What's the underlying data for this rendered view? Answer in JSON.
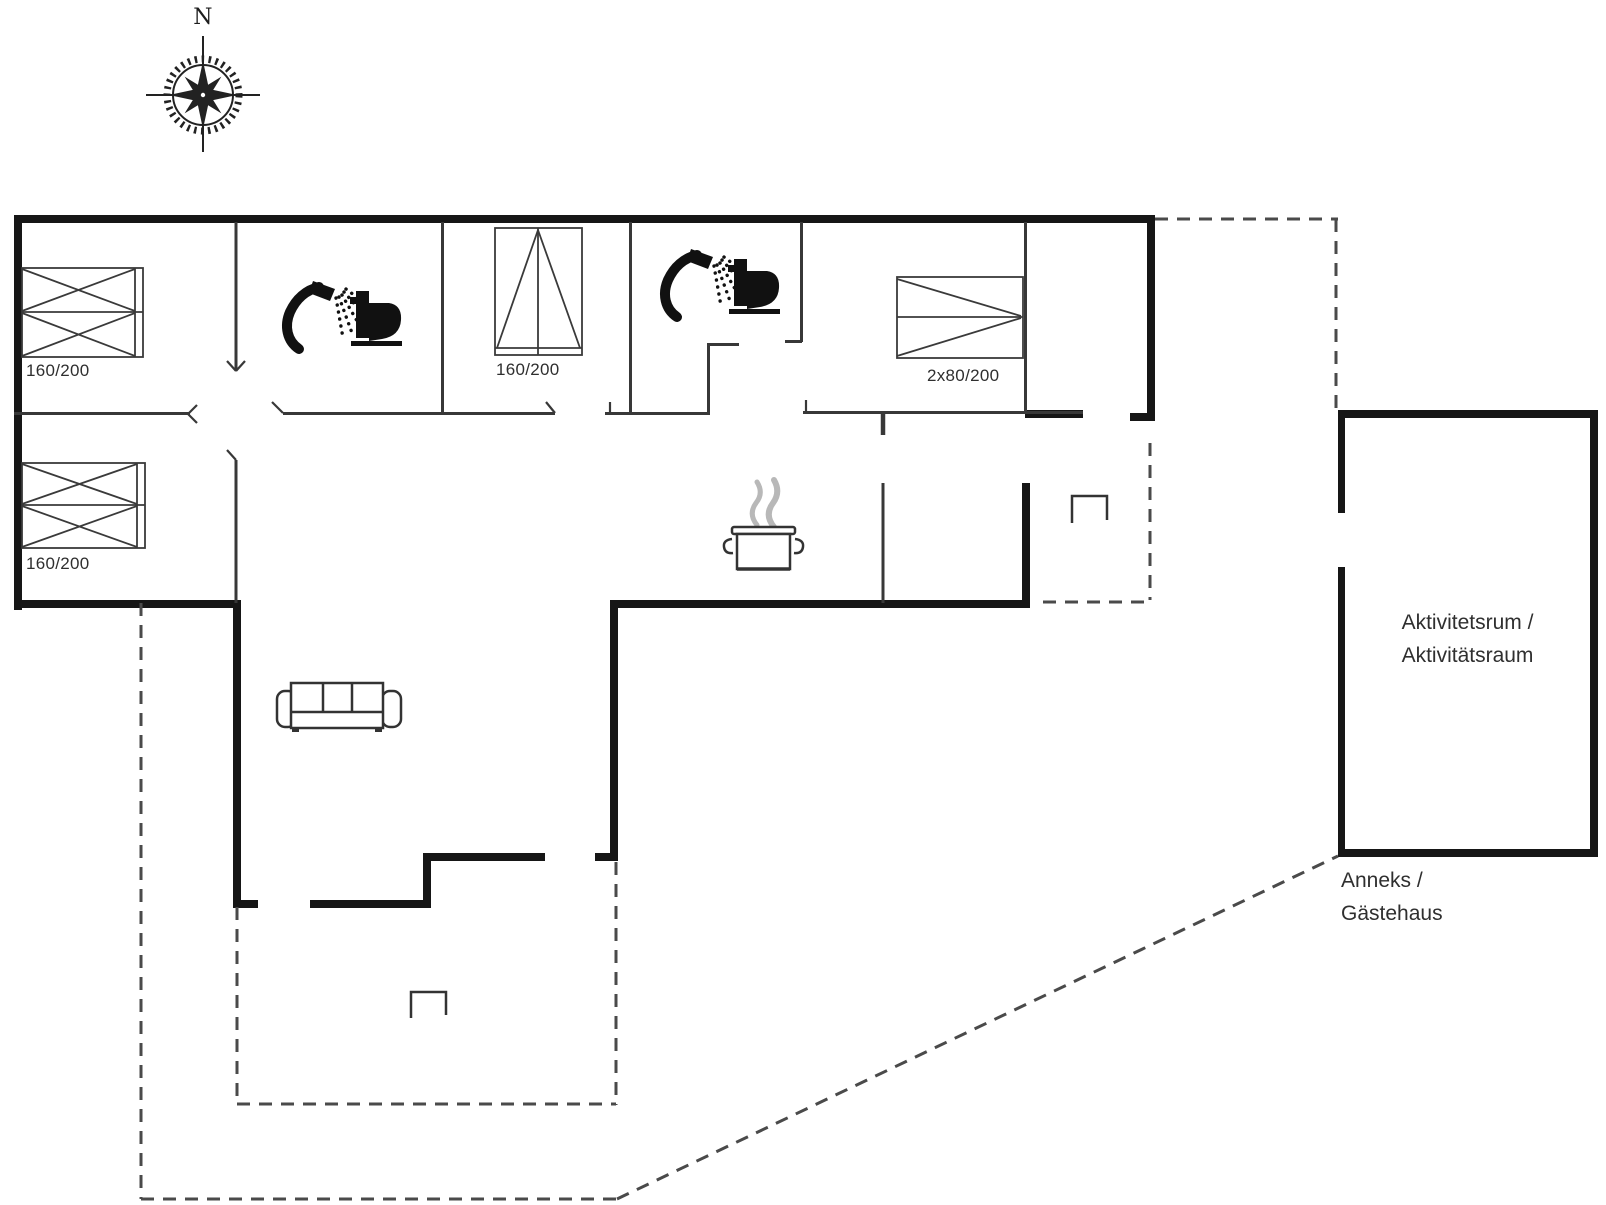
{
  "compass": {
    "north_label": "N"
  },
  "furniture_labels": {
    "bed_top_left": "160/200",
    "bed_bottom_left": "160/200",
    "bed_middle": "160/200",
    "bed_right": "2x80/200"
  },
  "rooms": {
    "activity_room": {
      "line1": "Aktivitetsrum /",
      "line2": "Aktivitätsraum"
    },
    "annex": {
      "line1": "Anneks /",
      "line2": "Gästehaus"
    }
  },
  "icons": [
    "compass-rose-icon",
    "shower-icon",
    "toilet-icon",
    "wardrobe-bed-icon",
    "double-bed-icon",
    "cooking-pot-icon",
    "sofa-icon",
    "stove-bracket-icon"
  ],
  "colors": {
    "background": "#ffffff",
    "thick_wall": "#161616",
    "thin_wall": "#383838",
    "dashed_line": "#4a4a4a",
    "steam": "#b8b8b8",
    "text": "#2f2f2f"
  }
}
